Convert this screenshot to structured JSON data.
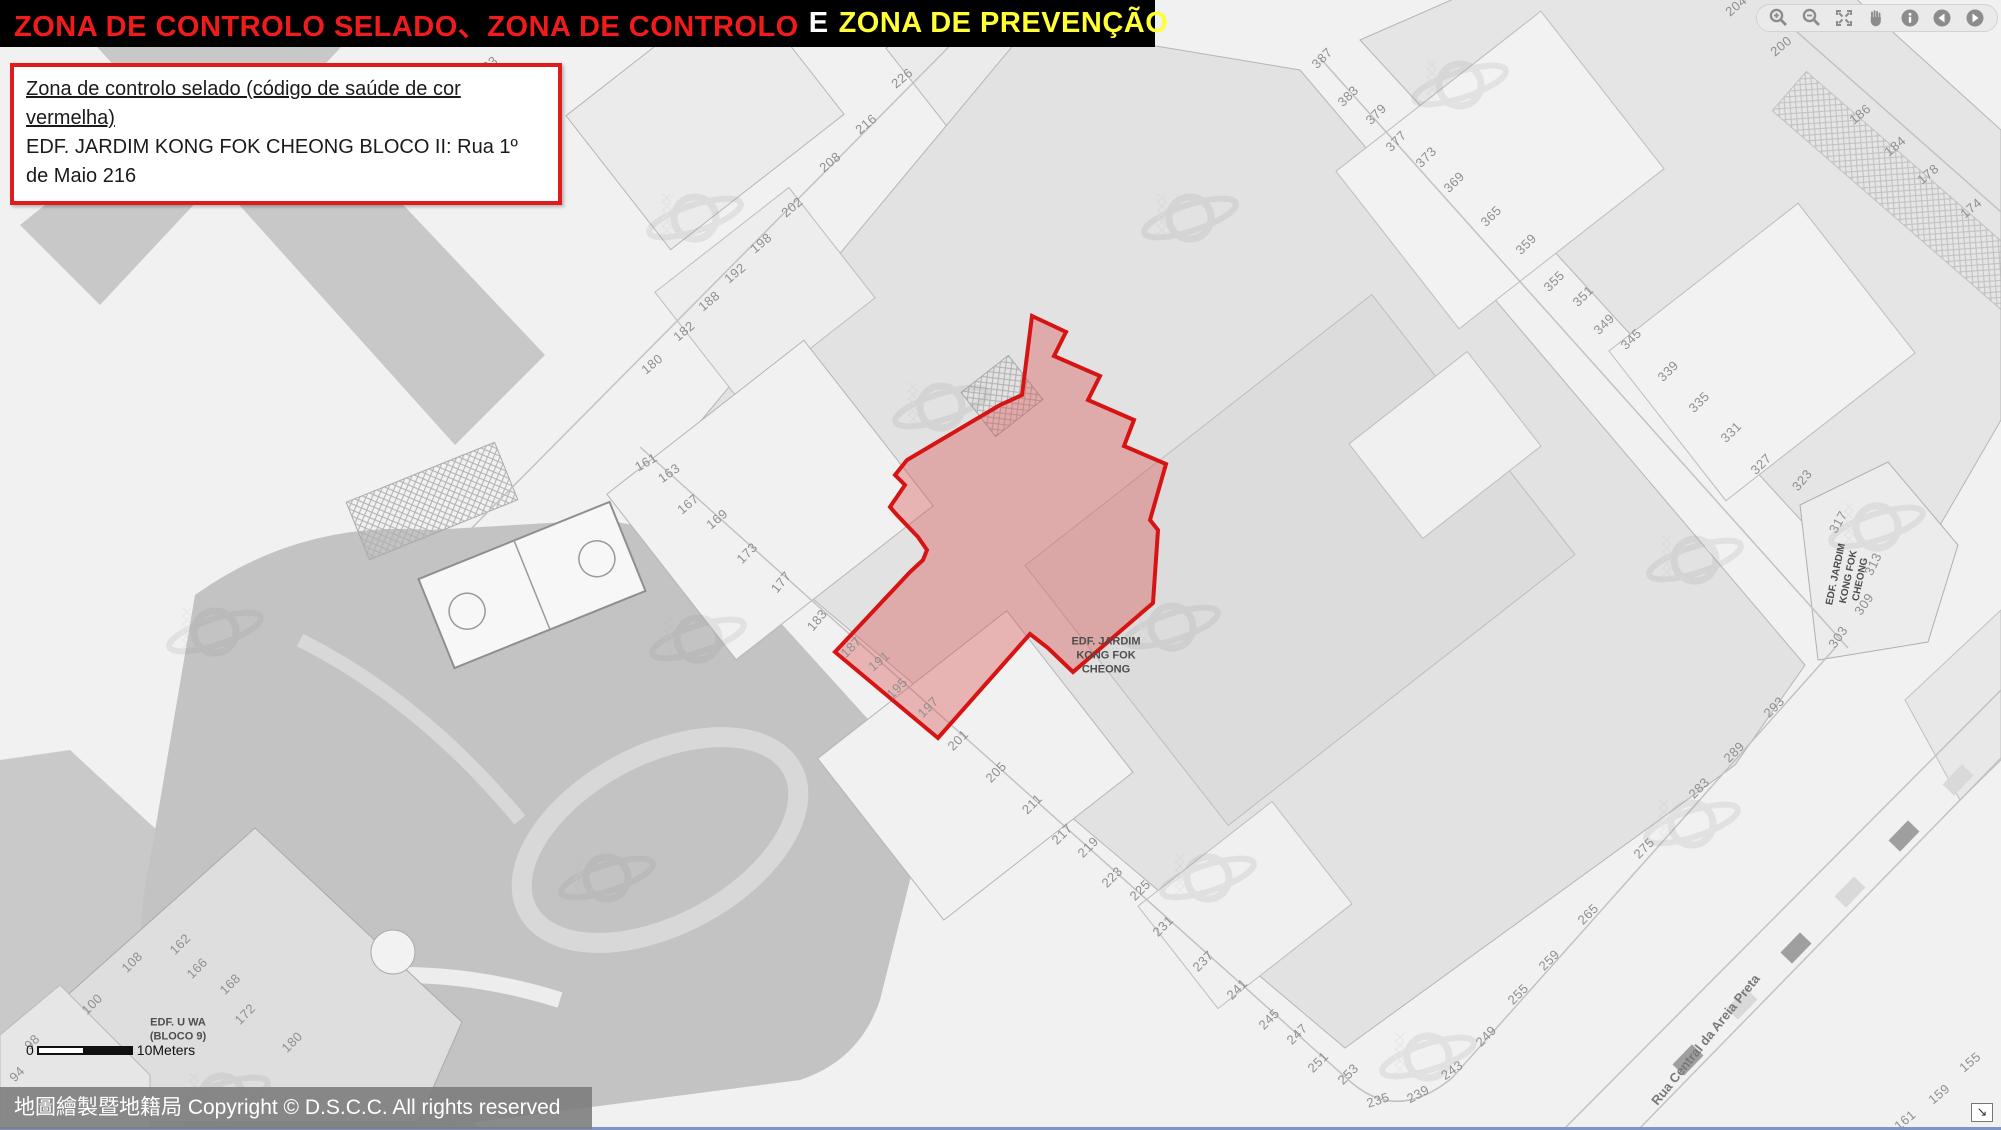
{
  "header": {
    "segment_red": "ZONA DE CONTROLO SELADO、ZONA DE CONTROLO",
    "segment_white": "E",
    "segment_yellow": "ZONA DE PREVENÇÃO"
  },
  "info_box": {
    "title_underlined": "Zona de controlo selado (código de saúde de cor vermelha)",
    "detail": "EDF. JARDIM KONG FOK CHEONG BLOCO II: Rua 1º de Maio 216"
  },
  "toolbar": {
    "buttons": [
      "Zoom in",
      "Zoom out",
      "Full extent",
      "Pan",
      "Identify",
      "Previous extent",
      "Next extent"
    ]
  },
  "map": {
    "sealed_zone": {
      "building": "EDF. JARDIM KONG FOK CHEONG BLOCO II",
      "address": "Rua 1º de Maio 216"
    },
    "labels": [
      {
        "id": "edf-jardim-kong-fok-cheong-center",
        "lines": [
          "EDF. JARDIM",
          "KONG FOK",
          "CHEONG"
        ],
        "x": 1106,
        "y": 656,
        "r": 0,
        "size": 11,
        "color": "#4d4d4d",
        "weight": 700
      },
      {
        "id": "edf-jardim-kong-fok-cheong-right",
        "lines": [
          "EDF. JARDIM",
          "KONG FOK",
          "CHEONG"
        ],
        "x": 1849,
        "y": 577,
        "r": -78,
        "size": 10,
        "color": "#4d4d4d",
        "weight": 700
      },
      {
        "id": "edf-u-wa-bloco-9",
        "lines": [
          "EDF. U WA",
          "(BLOCO 9)"
        ],
        "x": 178,
        "y": 1030,
        "r": 0,
        "size": 11,
        "color": "#4d4d4d",
        "weight": 700
      },
      {
        "id": "rua-central-da-areia-preta",
        "lines": [
          "Rua Central da Areia Preta"
        ],
        "x": 1706,
        "y": 1040,
        "r": -51,
        "size": 13,
        "color": "#787878",
        "weight": 700
      }
    ],
    "house_numbers": [
      {
        "n": "226",
        "x": 902,
        "y": 78,
        "r": -40
      },
      {
        "n": "216",
        "x": 866,
        "y": 124,
        "r": -40
      },
      {
        "n": "208",
        "x": 830,
        "y": 162,
        "r": -40
      },
      {
        "n": "202",
        "x": 792,
        "y": 207,
        "r": -40
      },
      {
        "n": "198",
        "x": 761,
        "y": 243,
        "r": -40
      },
      {
        "n": "192",
        "x": 735,
        "y": 273,
        "r": -40
      },
      {
        "n": "188",
        "x": 709,
        "y": 301,
        "r": -40
      },
      {
        "n": "182",
        "x": 684,
        "y": 331,
        "r": -40
      },
      {
        "n": "180",
        "x": 652,
        "y": 364,
        "r": -40
      },
      {
        "n": "203",
        "x": 487,
        "y": 66,
        "r": -40
      },
      {
        "n": "161",
        "x": 646,
        "y": 462,
        "r": -30
      },
      {
        "n": "163",
        "x": 669,
        "y": 473,
        "r": -35
      },
      {
        "n": "167",
        "x": 688,
        "y": 504,
        "r": -40
      },
      {
        "n": "169",
        "x": 717,
        "y": 519,
        "r": -40
      },
      {
        "n": "173",
        "x": 747,
        "y": 553,
        "r": -45
      },
      {
        "n": "177",
        "x": 781,
        "y": 582,
        "r": -50
      },
      {
        "n": "183",
        "x": 817,
        "y": 620,
        "r": -50
      },
      {
        "n": "187",
        "x": 851,
        "y": 647,
        "r": -45
      },
      {
        "n": "191",
        "x": 879,
        "y": 661,
        "r": -40
      },
      {
        "n": "195",
        "x": 897,
        "y": 688,
        "r": -45
      },
      {
        "n": "197",
        "x": 928,
        "y": 707,
        "r": -45
      },
      {
        "n": "201",
        "x": 958,
        "y": 740,
        "r": -45
      },
      {
        "n": "205",
        "x": 996,
        "y": 772,
        "r": -45
      },
      {
        "n": "211",
        "x": 1032,
        "y": 804,
        "r": -45
      },
      {
        "n": "217",
        "x": 1062,
        "y": 834,
        "r": -45
      },
      {
        "n": "219",
        "x": 1088,
        "y": 847,
        "r": -45
      },
      {
        "n": "223",
        "x": 1112,
        "y": 877,
        "r": -45
      },
      {
        "n": "225",
        "x": 1140,
        "y": 890,
        "r": -45
      },
      {
        "n": "231",
        "x": 1163,
        "y": 926,
        "r": -45
      },
      {
        "n": "237",
        "x": 1203,
        "y": 961,
        "r": -45
      },
      {
        "n": "241",
        "x": 1237,
        "y": 989,
        "r": -45
      },
      {
        "n": "245",
        "x": 1269,
        "y": 1019,
        "r": -45
      },
      {
        "n": "247",
        "x": 1297,
        "y": 1034,
        "r": -45
      },
      {
        "n": "251",
        "x": 1318,
        "y": 1062,
        "r": -45
      },
      {
        "n": "253",
        "x": 1348,
        "y": 1074,
        "r": -45
      },
      {
        "n": "235",
        "x": 1378,
        "y": 1100,
        "r": -18
      },
      {
        "n": "239",
        "x": 1418,
        "y": 1094,
        "r": -28
      },
      {
        "n": "243",
        "x": 1452,
        "y": 1070,
        "r": -35
      },
      {
        "n": "249",
        "x": 1486,
        "y": 1036,
        "r": -45
      },
      {
        "n": "255",
        "x": 1518,
        "y": 994,
        "r": -45
      },
      {
        "n": "259",
        "x": 1549,
        "y": 960,
        "r": -45
      },
      {
        "n": "265",
        "x": 1588,
        "y": 914,
        "r": -45
      },
      {
        "n": "275",
        "x": 1644,
        "y": 848,
        "r": -45
      },
      {
        "n": "283",
        "x": 1699,
        "y": 788,
        "r": -45
      },
      {
        "n": "289",
        "x": 1734,
        "y": 752,
        "r": -45
      },
      {
        "n": "293",
        "x": 1774,
        "y": 707,
        "r": -45
      },
      {
        "n": "303",
        "x": 1838,
        "y": 637,
        "r": -55
      },
      {
        "n": "309",
        "x": 1864,
        "y": 604,
        "r": -55
      },
      {
        "n": "313",
        "x": 1873,
        "y": 564,
        "r": -65
      },
      {
        "n": "317",
        "x": 1838,
        "y": 522,
        "r": -60
      },
      {
        "n": "323",
        "x": 1802,
        "y": 480,
        "r": -50
      },
      {
        "n": "327",
        "x": 1761,
        "y": 464,
        "r": -45
      },
      {
        "n": "331",
        "x": 1731,
        "y": 432,
        "r": -45
      },
      {
        "n": "335",
        "x": 1699,
        "y": 402,
        "r": -45
      },
      {
        "n": "339",
        "x": 1668,
        "y": 371,
        "r": -45
      },
      {
        "n": "345",
        "x": 1631,
        "y": 339,
        "r": -45
      },
      {
        "n": "349",
        "x": 1604,
        "y": 324,
        "r": -45
      },
      {
        "n": "351",
        "x": 1583,
        "y": 296,
        "r": -45
      },
      {
        "n": "355",
        "x": 1554,
        "y": 281,
        "r": -45
      },
      {
        "n": "359",
        "x": 1526,
        "y": 244,
        "r": -45
      },
      {
        "n": "365",
        "x": 1491,
        "y": 216,
        "r": -45
      },
      {
        "n": "369",
        "x": 1454,
        "y": 182,
        "r": -45
      },
      {
        "n": "373",
        "x": 1426,
        "y": 157,
        "r": -45
      },
      {
        "n": "377",
        "x": 1396,
        "y": 141,
        "r": -45
      },
      {
        "n": "379",
        "x": 1376,
        "y": 114,
        "r": -45
      },
      {
        "n": "383",
        "x": 1348,
        "y": 96,
        "r": -45
      },
      {
        "n": "387",
        "x": 1322,
        "y": 58,
        "r": -45
      },
      {
        "n": "204",
        "x": 1736,
        "y": 6,
        "r": -40
      },
      {
        "n": "202",
        "x": 1768,
        "y": 14,
        "r": -40
      },
      {
        "n": "200",
        "x": 1781,
        "y": 46,
        "r": -40
      },
      {
        "n": "186",
        "x": 1860,
        "y": 114,
        "r": -40
      },
      {
        "n": "184",
        "x": 1895,
        "y": 146,
        "r": -40
      },
      {
        "n": "178",
        "x": 1928,
        "y": 174,
        "r": -40
      },
      {
        "n": "174",
        "x": 1971,
        "y": 208,
        "r": -40
      },
      {
        "n": "98",
        "x": 32,
        "y": 1042,
        "r": -45
      },
      {
        "n": "94",
        "x": 17,
        "y": 1074,
        "r": -45
      },
      {
        "n": "100",
        "x": 92,
        "y": 1004,
        "r": -45
      },
      {
        "n": "108",
        "x": 132,
        "y": 962,
        "r": -45
      },
      {
        "n": "162",
        "x": 180,
        "y": 944,
        "r": -45
      },
      {
        "n": "166",
        "x": 197,
        "y": 968,
        "r": -45
      },
      {
        "n": "168",
        "x": 230,
        "y": 984,
        "r": -45
      },
      {
        "n": "172",
        "x": 245,
        "y": 1014,
        "r": -45
      },
      {
        "n": "180",
        "x": 292,
        "y": 1042,
        "r": -45
      },
      {
        "n": "155",
        "x": 1970,
        "y": 1062,
        "r": -40
      },
      {
        "n": "159",
        "x": 1939,
        "y": 1094,
        "r": -40
      },
      {
        "n": "161",
        "x": 1905,
        "y": 1120,
        "r": -40
      }
    ],
    "scale_bar": {
      "start": "0",
      "end": "10Meters"
    }
  },
  "footer": {
    "copyright": "地圖繪製暨地籍局 Copyright © D.S.C.C. All rights reserved"
  },
  "colors": {
    "header_red": "#f21b1b",
    "header_yellow": "#ffff33",
    "zone_stroke": "#d61414",
    "zone_fill": "rgba(219,80,80,0.38)",
    "info_border": "#e01b1b"
  }
}
